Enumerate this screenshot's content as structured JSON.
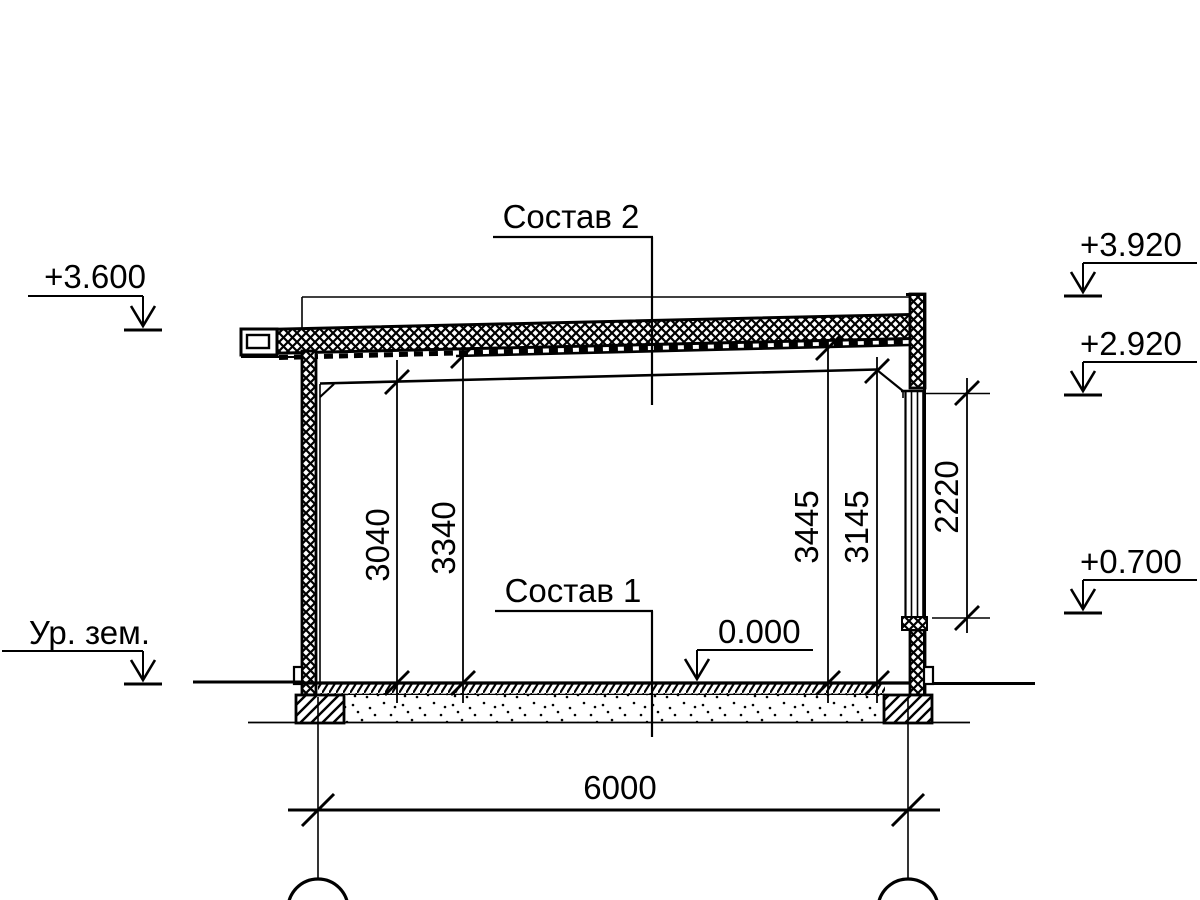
{
  "labels": {
    "composition2": "Состав 2",
    "composition1": "Состав 1",
    "ground_level": "Ур. зем."
  },
  "elevations": {
    "eave": "+3.600",
    "parapet": "+3.920",
    "ceiling": "+2.920",
    "sill": "+0.700",
    "floor": "0.000"
  },
  "dimensions": {
    "span": "6000",
    "height_left_clear": "3040",
    "height_left_deck": "3340",
    "height_right_deck": "3445",
    "height_right_clear": "3145",
    "window_height": "2220"
  },
  "colors": {
    "line": "#000000",
    "background": "#ffffff"
  }
}
